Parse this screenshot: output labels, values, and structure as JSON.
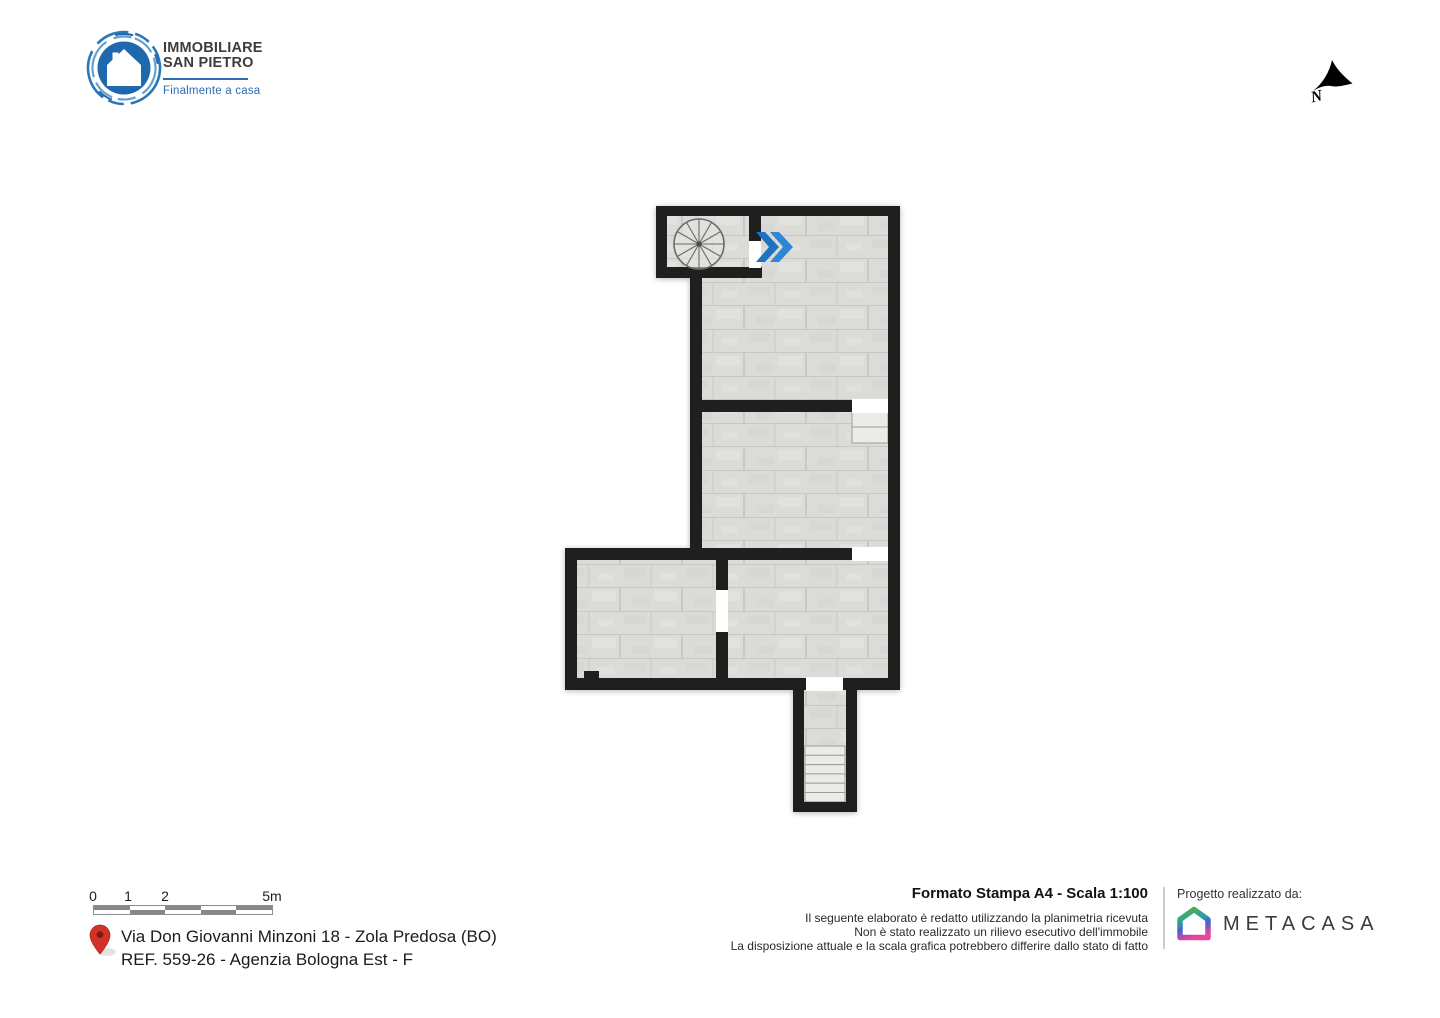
{
  "brand": {
    "title_line1": "IMMOBILIARE",
    "title_line2": "SAN PIETRO",
    "tagline": "Finalmente a casa",
    "blue": "#2a6db5"
  },
  "compass": {
    "label": "N"
  },
  "floorplan": {
    "wall_color": "#1f1f1f",
    "floor_color": "#dbdbd8",
    "entry_arrow_color": "#2e86d6",
    "features": {
      "spiral_staircase": "spiral staircase (top-left room)",
      "entry_arrow": "blue double-chevron entry arrow",
      "stairs_mid_right": "2 steps below right-side door",
      "stairs_bottom": "6-step staircase in bottom corridor"
    }
  },
  "footer": {
    "scale_bar": {
      "labels": [
        "0",
        "1",
        "2",
        "5m"
      ]
    },
    "location": {
      "line1": "Via Don Giovanni Minzoni 18 - Zola Predosa (BO)",
      "line2": "REF. 559-26 - Agenzia Bologna Est - F"
    },
    "print": {
      "title": "Formato Stampa A4 - Scala 1:100",
      "disclaimer1": "Il seguente elaborato è redatto utilizzando la planimetria ricevuta",
      "disclaimer2": "Non è stato realizzato un rilievo esecutivo dell'immobile",
      "disclaimer3": "La disposizione attuale e la scala grafica potrebbero differire dallo stato di fatto"
    },
    "credit": {
      "label": "Progetto realizzato da:",
      "brand": "METACASA"
    }
  }
}
